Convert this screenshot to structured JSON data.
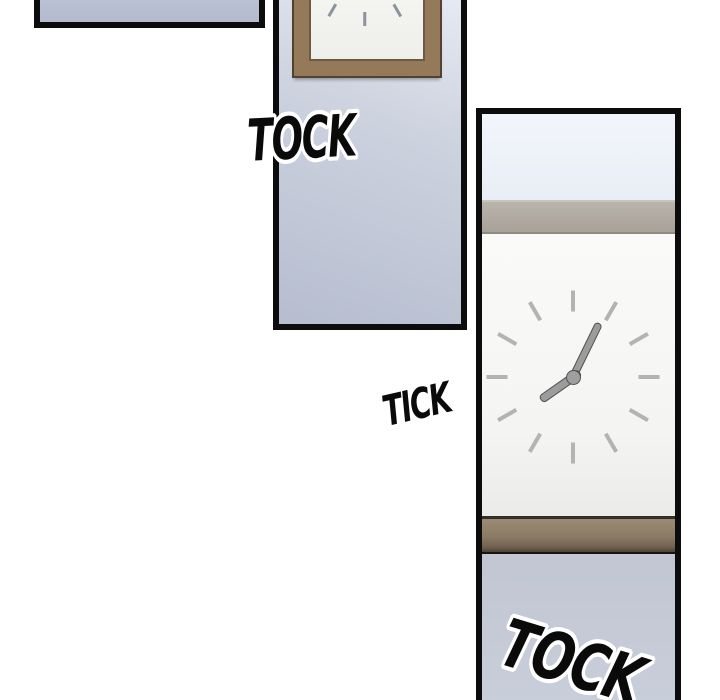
{
  "sfx": {
    "tock_top": "TOCK",
    "tick": "TICK",
    "tock_bottom": "TOCK"
  },
  "clocks": {
    "wall_clock": {
      "tick_count": 12,
      "minute_angle_deg": 26,
      "hour_angle_deg": 235,
      "time_shown": "about 7:05"
    },
    "framed_clock": {
      "tick_count": 12
    }
  },
  "colors": {
    "ink": "#0c0c0c",
    "panel_wall_blue": "#bcc3d4",
    "panel_sky_blue": "#eff3fa",
    "clock_wall_white": "#f6f6f4",
    "frame_wood": "#957a5a",
    "shelf_top_wood": "#aea89f",
    "shelf_bottom_wood": "#8b7a64",
    "tick_gray": "#b3b3b3",
    "hand_gray": "#9c9c9c",
    "sfx_fill": "#0a0a0a",
    "sfx_outline": "#ffffff"
  }
}
